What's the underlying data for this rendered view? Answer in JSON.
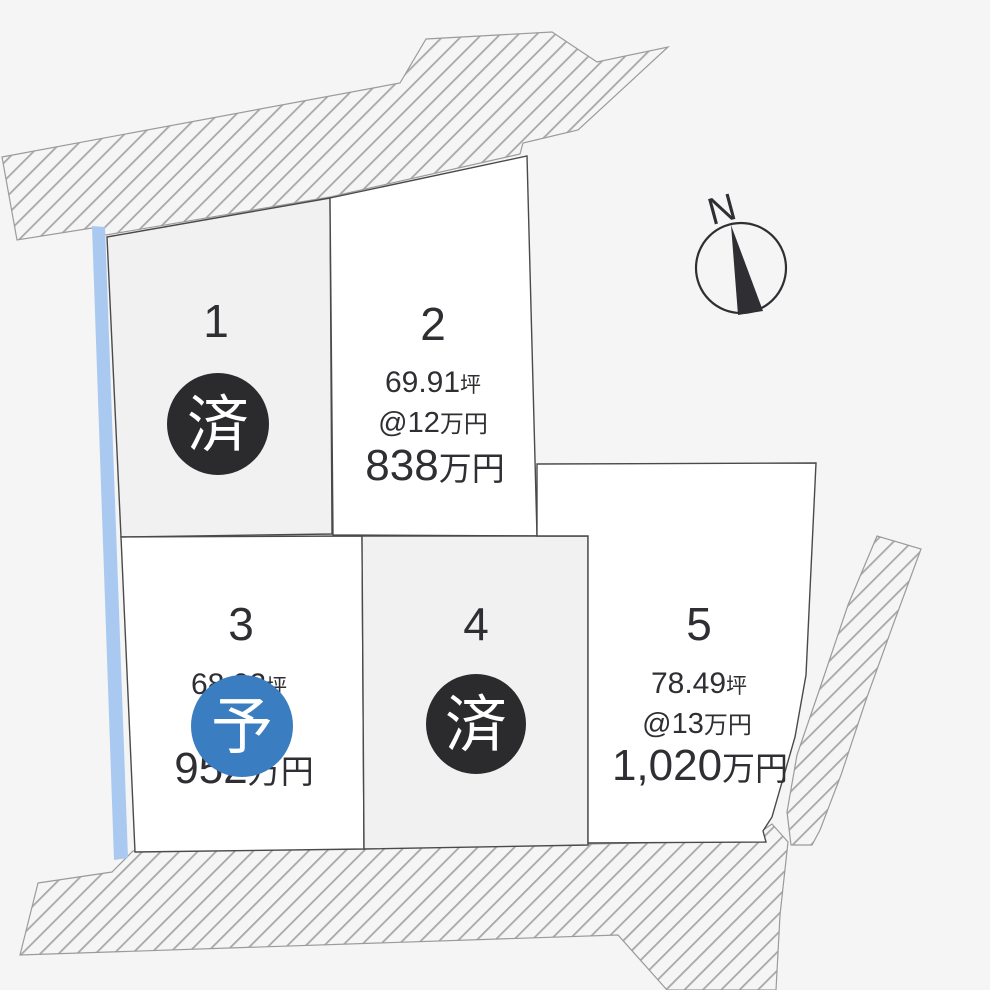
{
  "colors": {
    "background": "#f5f5f6",
    "lot_fill_sold": "#f1f1f2",
    "lot_fill_available": "#ffffff",
    "lot_border": "#4a4a4a",
    "hatch_line": "#a8a8ab",
    "hatch_border": "#9b9b9e",
    "blue_strip": "#a9c9f1",
    "text": "#2f2f33",
    "badge_sold": "#2b2b2e",
    "badge_reserved": "#3a7dc0",
    "badge_text": "#ffffff"
  },
  "compass": {
    "label": "N"
  },
  "lots": [
    {
      "number": "1",
      "status": "済"
    },
    {
      "number": "2",
      "area": "69.91",
      "area_unit": "坪",
      "unit_price": "@12",
      "unit_price_unit": "万円",
      "price": "838",
      "price_unit": "万円"
    },
    {
      "number": "3",
      "area": "68.02",
      "area_unit": "坪",
      "price": "952",
      "price_unit": "万円",
      "status": "予"
    },
    {
      "number": "4",
      "status": "済"
    },
    {
      "number": "5",
      "area": "78.49",
      "area_unit": "坪",
      "unit_price": "@13",
      "unit_price_unit": "万円",
      "price": "1,020",
      "price_unit": "万円"
    }
  ]
}
